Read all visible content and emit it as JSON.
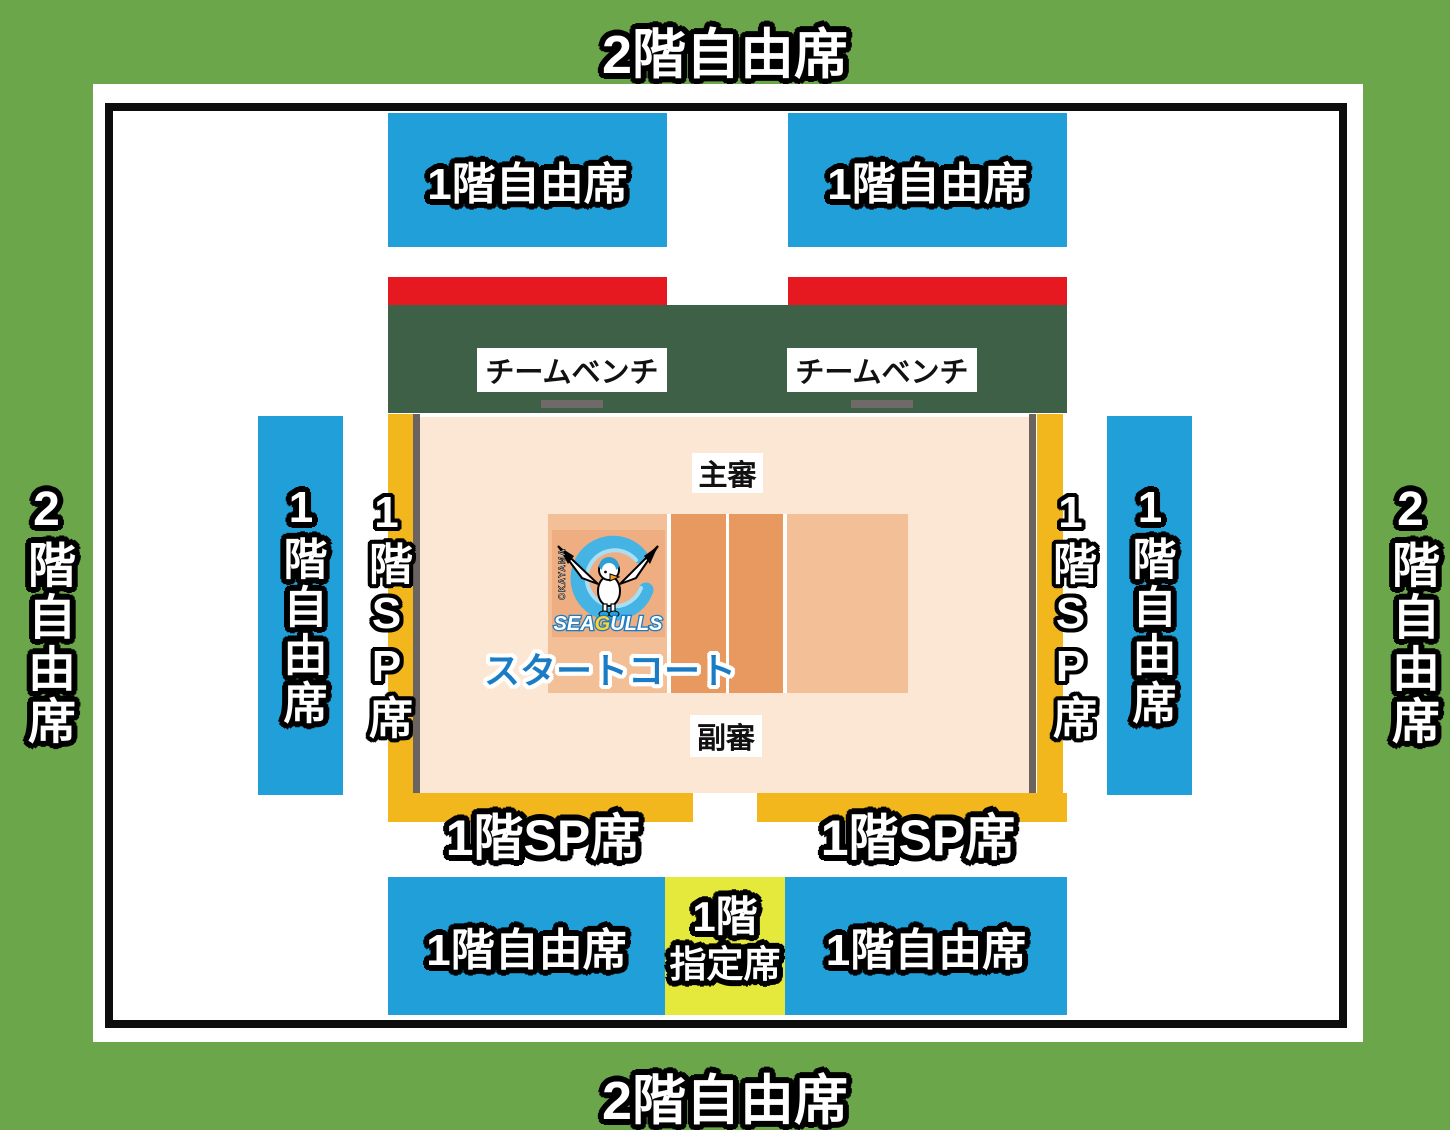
{
  "colors": {
    "outer_green": "#6ca64b",
    "arena_white": "#ffffff",
    "border_black": "#0d0d0d",
    "free_seat_blue": "#219fd9",
    "red_strip": "#e61820",
    "bench_dark_green": "#3e6046",
    "sp_seat_yellow": "#f2b71d",
    "reserved_yellow_green": "#e5e93c",
    "court_floor_peach": "#fbe7d3",
    "court_side_salmon": "#f3bf97",
    "court_center_orange": "#e8995f",
    "court_edge_gray": "#6b635f",
    "bench_bar_gray": "#6f6a68",
    "start_court_blue": "#1a7cc4"
  },
  "seats": {
    "floor2_free": {
      "label": "2階自由席"
    },
    "floor1_free": {
      "label": "1階自由席"
    },
    "floor1_sp": {
      "label": "1階SP席"
    },
    "floor1_reserved": {
      "line1": "1階",
      "line2": "指定席"
    }
  },
  "bench": {
    "label": "チームベンチ"
  },
  "referees": {
    "chief": "主審",
    "assistant": "副審"
  },
  "court": {
    "start_court_label": "スタートコート"
  },
  "logo": {
    "okayama": "OKAYAMA",
    "seagulls_sea": "SEA",
    "seagulls_g": "G",
    "seagulls_ulls": "ULLS"
  }
}
